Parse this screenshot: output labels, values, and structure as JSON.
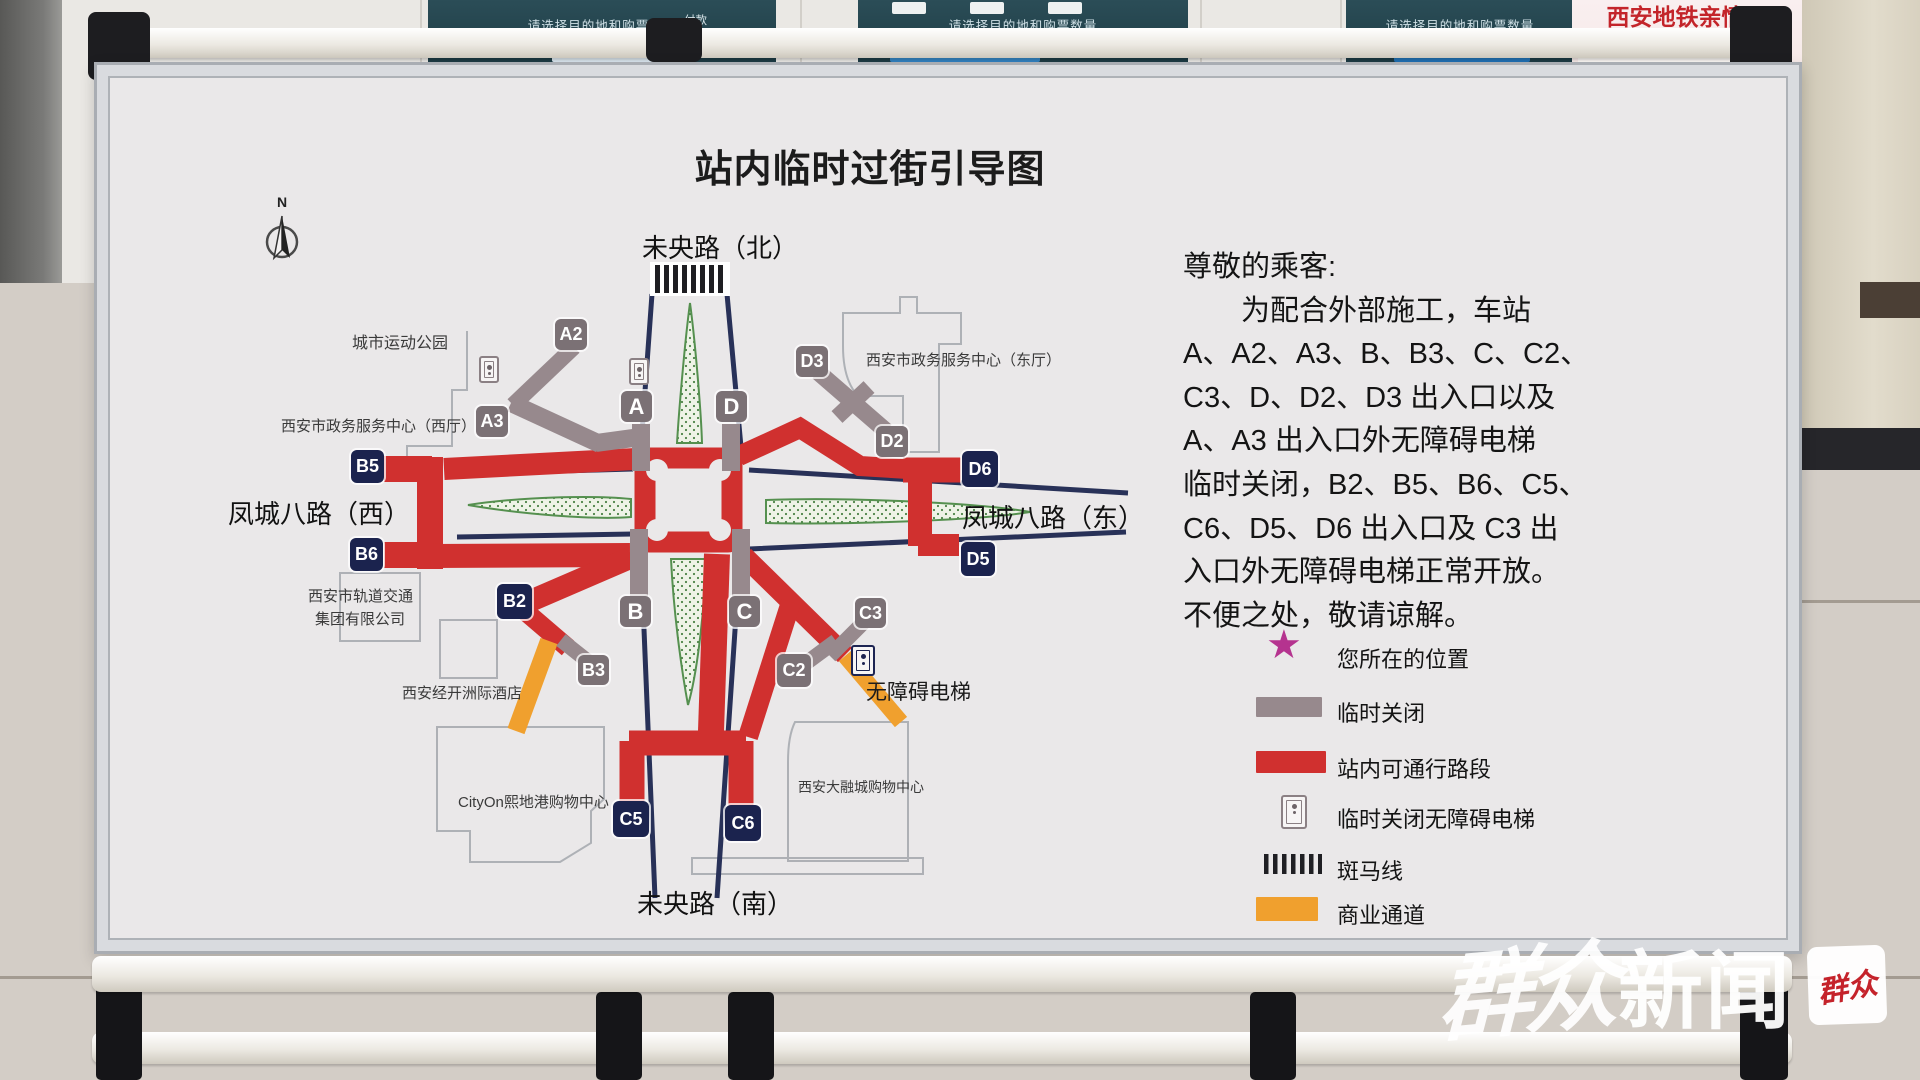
{
  "scene": {
    "machines": {
      "header": "请选择目的地和购票数量",
      "pay": "付款"
    },
    "poster": {
      "title": "西安地铁亲情票",
      "subtitle": "一人购票 多人乘车"
    },
    "watermark": {
      "script": "群众",
      "suffix": "新闻",
      "badge": "群众"
    }
  },
  "board": {
    "title": "站内临时过街引导图",
    "compass": "N",
    "roads": {
      "north": "未央路（北）",
      "south": "未央路（南）",
      "west": "凤城八路（西）",
      "east": "凤城八路（东）"
    },
    "exits": {
      "A": "A",
      "A2": "A2",
      "A3": "A3",
      "B": "B",
      "B2": "B2",
      "B3": "B3",
      "B5": "B5",
      "B6": "B6",
      "C": "C",
      "C2": "C2",
      "C3": "C3",
      "C5": "C5",
      "C6": "C6",
      "D": "D",
      "D2": "D2",
      "D3": "D3",
      "D5": "D5",
      "D6": "D6"
    },
    "exit_status": {
      "closed": [
        "A",
        "A2",
        "A3",
        "B",
        "B3",
        "C",
        "C2",
        "C3",
        "D",
        "D2",
        "D3"
      ],
      "open": [
        "B2",
        "B5",
        "B6",
        "C5",
        "C6",
        "D5",
        "D6"
      ]
    },
    "places": {
      "park": "城市运动公园",
      "west_hall": "西安市政务服务中心（西厅）",
      "east_hall": "西安市政务服务中心（东厅）",
      "metro_group_1": "西安市轨道交通",
      "metro_group_2": "集团有限公司",
      "hotel": "西安经开洲际酒店",
      "cityon": "CityOn熙地港购物中心",
      "darongcheng": "西安大融城购物中心",
      "elevator": "无障碍电梯"
    },
    "notice": {
      "lines": [
        "尊敬的乘客:",
        "为配合外部施工，车站",
        "A、A2、A3、B、B3、C、C2、",
        "C3、D、D2、D3 出入口以及",
        "A、A3 出入口外无障碍电梯",
        "临时关闭，B2、B5、B6、C5、",
        "C6、D5、D6 出入口及 C3 出",
        "入口外无障碍电梯正常开放。",
        "不便之处，敬请谅解。"
      ]
    },
    "legend": [
      {
        "icon": "star",
        "label": "您所在的位置"
      },
      {
        "icon": "gray-bar",
        "label": "临时关闭"
      },
      {
        "icon": "red-bar",
        "label": "站内可通行路段"
      },
      {
        "icon": "elevator",
        "label": "临时关闭无障碍电梯"
      },
      {
        "icon": "zebra",
        "label": "斑马线"
      },
      {
        "icon": "orange-bar",
        "label": "商业通道"
      }
    ],
    "colors": {
      "closed_gray": "#97898d",
      "open_red": "#d0302f",
      "exit_closed": "#7b7175",
      "exit_open": "#1b234e",
      "commercial_orange": "#f0a02e",
      "star_magenta": "#b5338f",
      "road_navy": "#283158",
      "median_green": "#55904f"
    }
  }
}
